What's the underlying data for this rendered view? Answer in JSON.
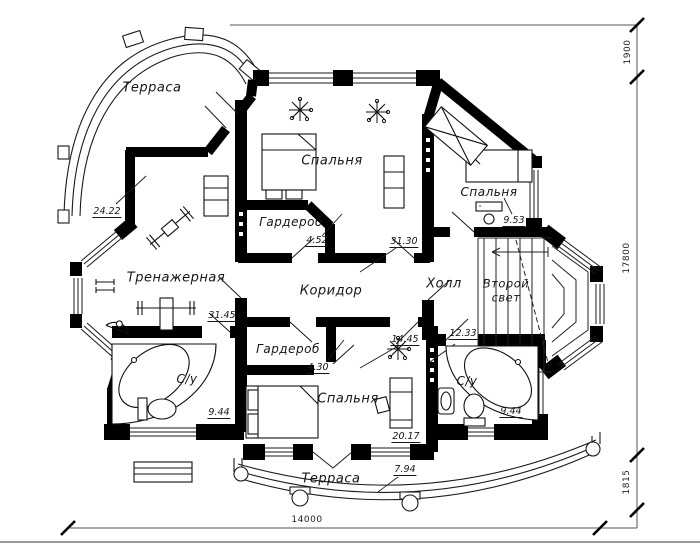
{
  "rooms": {
    "terrace_top": {
      "label": "Терраса",
      "area": "24.22"
    },
    "bedroom_top": {
      "label": "Спальня",
      "area": "31.30"
    },
    "wardrobe_top": {
      "label": "Гардероб",
      "area": "4.52"
    },
    "gym": {
      "label": "Тренажерная",
      "area": "31.45"
    },
    "corridor": {
      "label": "Коридор",
      "area": "14.45"
    },
    "hall": {
      "label": "Холл",
      "area": "12.33"
    },
    "bedroom_right": {
      "label": "Спальня",
      "area": "9.53"
    },
    "second_light": {
      "label": "Второй свет"
    },
    "bathroom_left": {
      "label": "С/у",
      "area": "9.44"
    },
    "wardrobe_bottom": {
      "label": "Гардероб",
      "area": "4.30"
    },
    "bedroom_bottom": {
      "label": "Спальня",
      "area": "20.17"
    },
    "bathroom_right": {
      "label": "С/у",
      "area": "9.44"
    },
    "terrace_bottom": {
      "label": "Терраса",
      "area": "7.94"
    }
  },
  "dimensions": {
    "right_top": "1900",
    "right_middle": "17800",
    "right_bottom": "1815",
    "bottom_width": "14000"
  },
  "colors": {
    "wall": "#000000",
    "line": "#1a1a1a",
    "background": "#ffffff"
  }
}
